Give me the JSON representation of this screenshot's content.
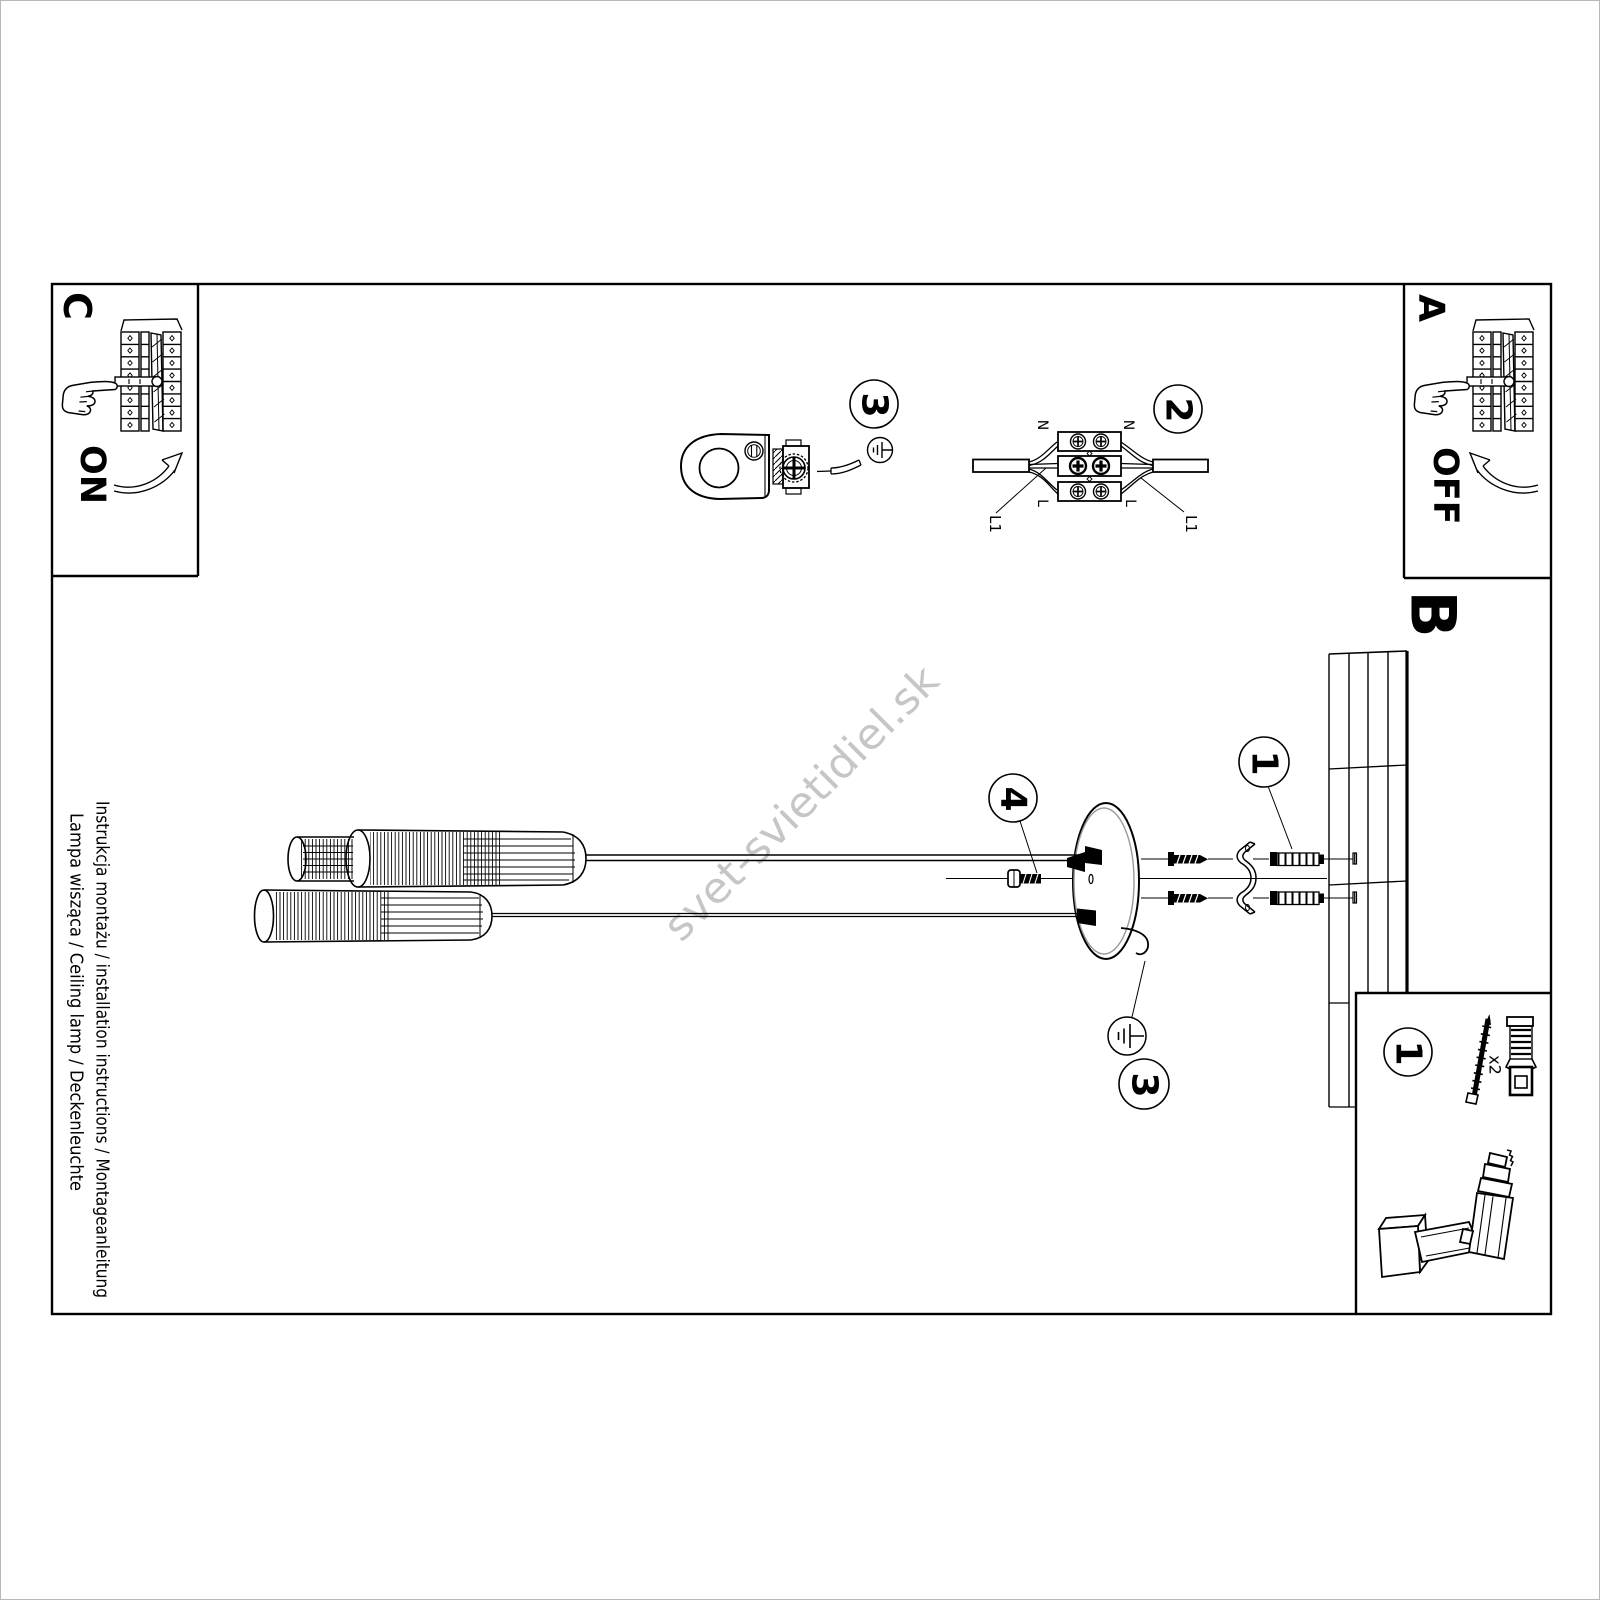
{
  "document": {
    "watermark": "svet-svietidiel.sk",
    "title_line1": "Instrukcja montażu / installation instructions / Montageanleitung",
    "title_line2": "Lampa wisząca / Ceiling lamp / Deckenleuchte"
  },
  "steps": {
    "step_a": {
      "label": "A",
      "switch_state": "OFF"
    },
    "step_b": {
      "label": "B"
    },
    "step_c": {
      "label": "C",
      "switch_state": "ON"
    }
  },
  "callouts": {
    "item1": "1",
    "item2": "2",
    "item3": "3",
    "item4": "4"
  },
  "wiring_labels": {
    "neutral": "N",
    "live": "L",
    "live1": "L1"
  },
  "hardware": {
    "screw_qty": "x2"
  },
  "colors": {
    "line": "#000000",
    "watermark": "#c6c6c6",
    "canopy_inner": "#999999",
    "page_border": "#b7b7b7",
    "background": "#ffffff"
  }
}
